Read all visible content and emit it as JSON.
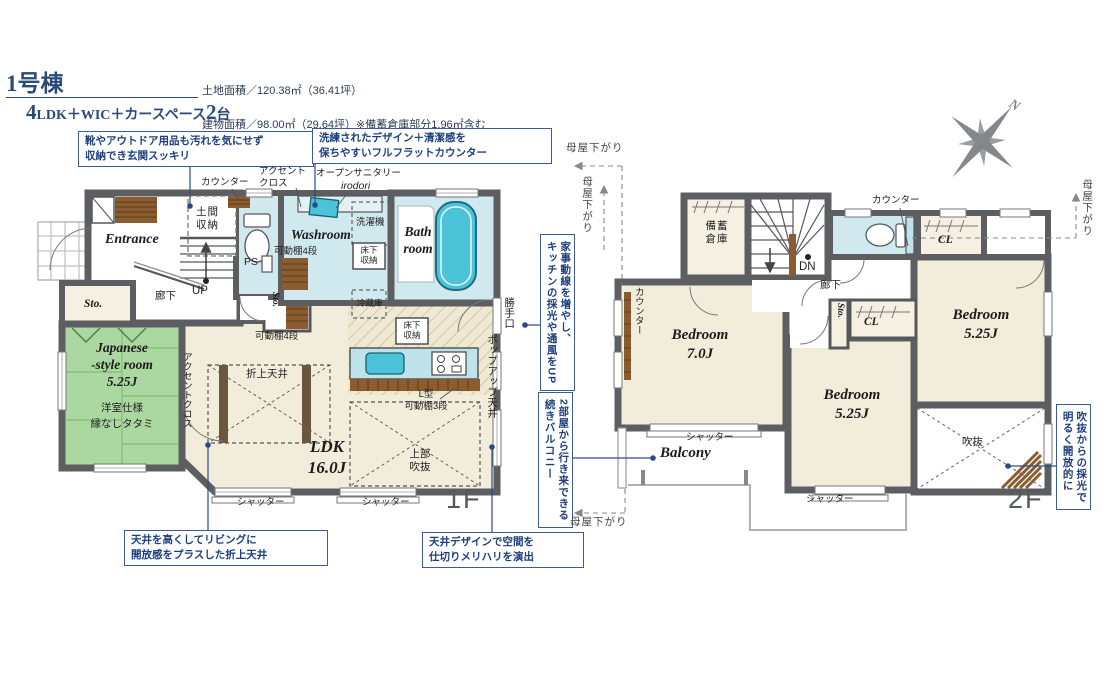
{
  "colors": {
    "accent": "#1d3f7e",
    "callout_border": "#3c5a96",
    "wall": "#5c5e62",
    "water": "#cfe9ee",
    "tatami": "#abd7a0",
    "room_beige": "#f2ecda",
    "storage_beige": "#f6f0e2",
    "wood": "#8a5c30",
    "tub": "#4cc3d9",
    "counter": "#bfe3ea",
    "gray_label": "#55585c"
  },
  "header": {
    "building_no": "1号棟",
    "unit_plan_num": "4",
    "unit_plan_mid": "LDK＋WIC＋カースペース",
    "car_num": "2",
    "car_suffix": "台",
    "land_area": "土地面積／120.38㎡（36.41坪）",
    "building_area": "建物面積／98.00㎡（29.64坪）※備蓄倉庫部分1.96㎡含む",
    "confirmation_no": "建築確認番号／第R07SHC125509号"
  },
  "compass": {
    "north": "N"
  },
  "callouts": {
    "entrance": "靴やアウトドア用品も汚れを気にせず\n収納でき玄関スッキリ",
    "sanitary": "洗練されたデザイン＋清潔感を\n保ちやすいフルフラットカウンター",
    "oriage": "天井を高くしてリビングに\n開放感をプラスした折上天井",
    "ceiling_design": "天井デザインで空間を\n仕切りメリハリを演出",
    "kitchen": "家事動線を増やし、\nキッチンの採光や通風をUP",
    "balcony": "2部屋から行き来できる\n続きバルコニー",
    "void_light": "吹抜からの採光で\n明るく開放的に"
  },
  "f1": {
    "floor": "1F",
    "entrance": "Entrance",
    "doma": "土間\n収納",
    "counter": "カウンター",
    "accent_cloth": "アクセント\nクロス",
    "open_sanitary": "オープンサニタリー",
    "irodori": "irodori",
    "washer": "洗濯機",
    "washroom": "Washroom",
    "shelf4_wash": "可動棚4段",
    "ps": "PS",
    "underfloor_wash": "床下\n収納",
    "bath": "Bath\nroom",
    "up": "UP",
    "hallway": "廊下",
    "sto_left": "Sto.",
    "sto_mid": "Sto.",
    "jroom": "Japanese\n-style room\n5.25J",
    "jroom_spec": "洋室仕様",
    "jroom_tatami": "縁なしタタミ",
    "accent_ldk": "アクセントクロス",
    "shelf4_ldk": "可動棚4段",
    "oriage": "折上天井",
    "ldk": "LDK\n16.0J",
    "fridge": "冷蔵庫",
    "underfloor_kitchen": "床下\n収納",
    "l_shelf": "L型\n可動棚3段",
    "upper_void": "上部\n吹抜",
    "shutter_a": "シャッター",
    "shutter_b": "シャッター",
    "katteguchi": "勝手口",
    "popup_ceiling": "ポップアップ天井"
  },
  "f2": {
    "floor": "2F",
    "moya": "母屋下がり",
    "bichiku": "備蓄\n倉庫",
    "dn": "DN",
    "hallway": "廊下",
    "counter_toilet": "カウンター",
    "cl_top": "CL",
    "counter_bed": "カウンター",
    "sto": "Sto.",
    "cl_mid": "CL",
    "bed7": "Bedroom\n7.0J",
    "bed525_mid": "Bedroom\n5.25J",
    "bed525_right": "Bedroom\n5.25J",
    "void": "吹抜",
    "shutter_a": "シャッター",
    "shutter_b": "シャッター",
    "balcony": "Balcony"
  }
}
